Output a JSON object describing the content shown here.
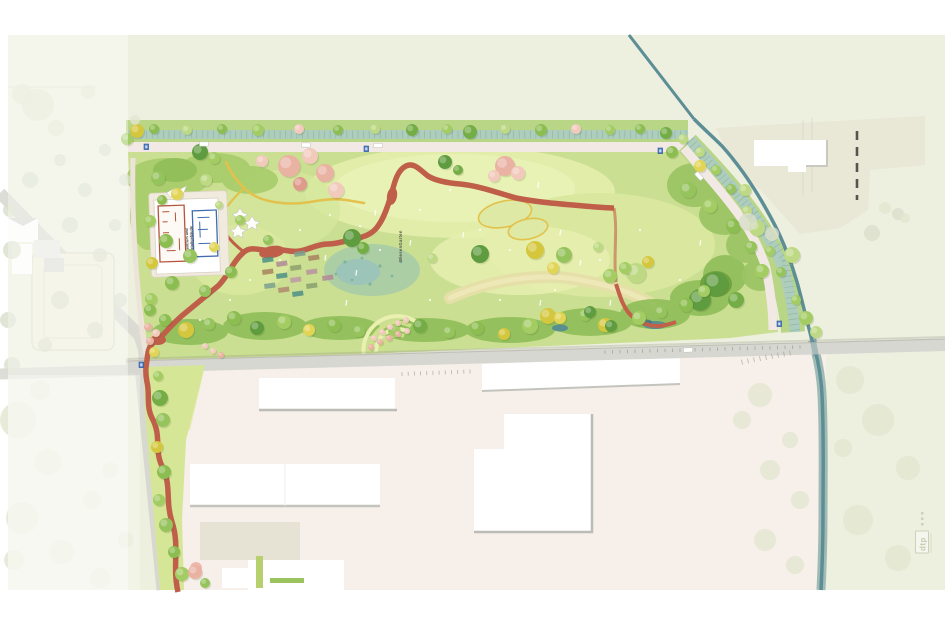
{
  "plan": {
    "labels": {
      "building_line1": "Infozentrum und",
      "building_line2": "Werkstattgebäude",
      "garden_area": "WiesenGarten",
      "logo": "dtp"
    },
    "icons": {
      "bus_stop": "bus-stop-icon",
      "car": "car-icon",
      "tree": "tree-icon"
    },
    "colors": {
      "plan_background": "#edefdf",
      "park_green": "#cbdf92",
      "meadow_light": "#e8efb4",
      "canopy_dark_green": "#8fbe58",
      "path_red": "#bf5f4a",
      "path_yellow": "#e2c24c",
      "road_pale": "#f2e9e5",
      "road_gray": "#d7d7d1",
      "channel_fill": "#aecdbd",
      "stream_teal": "#5d8e96",
      "ground_industrial": "#f7efe9",
      "building_white": "#ffffff",
      "sign_blue": "#4d7fc4",
      "blossom_pink": "#eab5a6",
      "context_faint": "#e4e8d2"
    }
  }
}
